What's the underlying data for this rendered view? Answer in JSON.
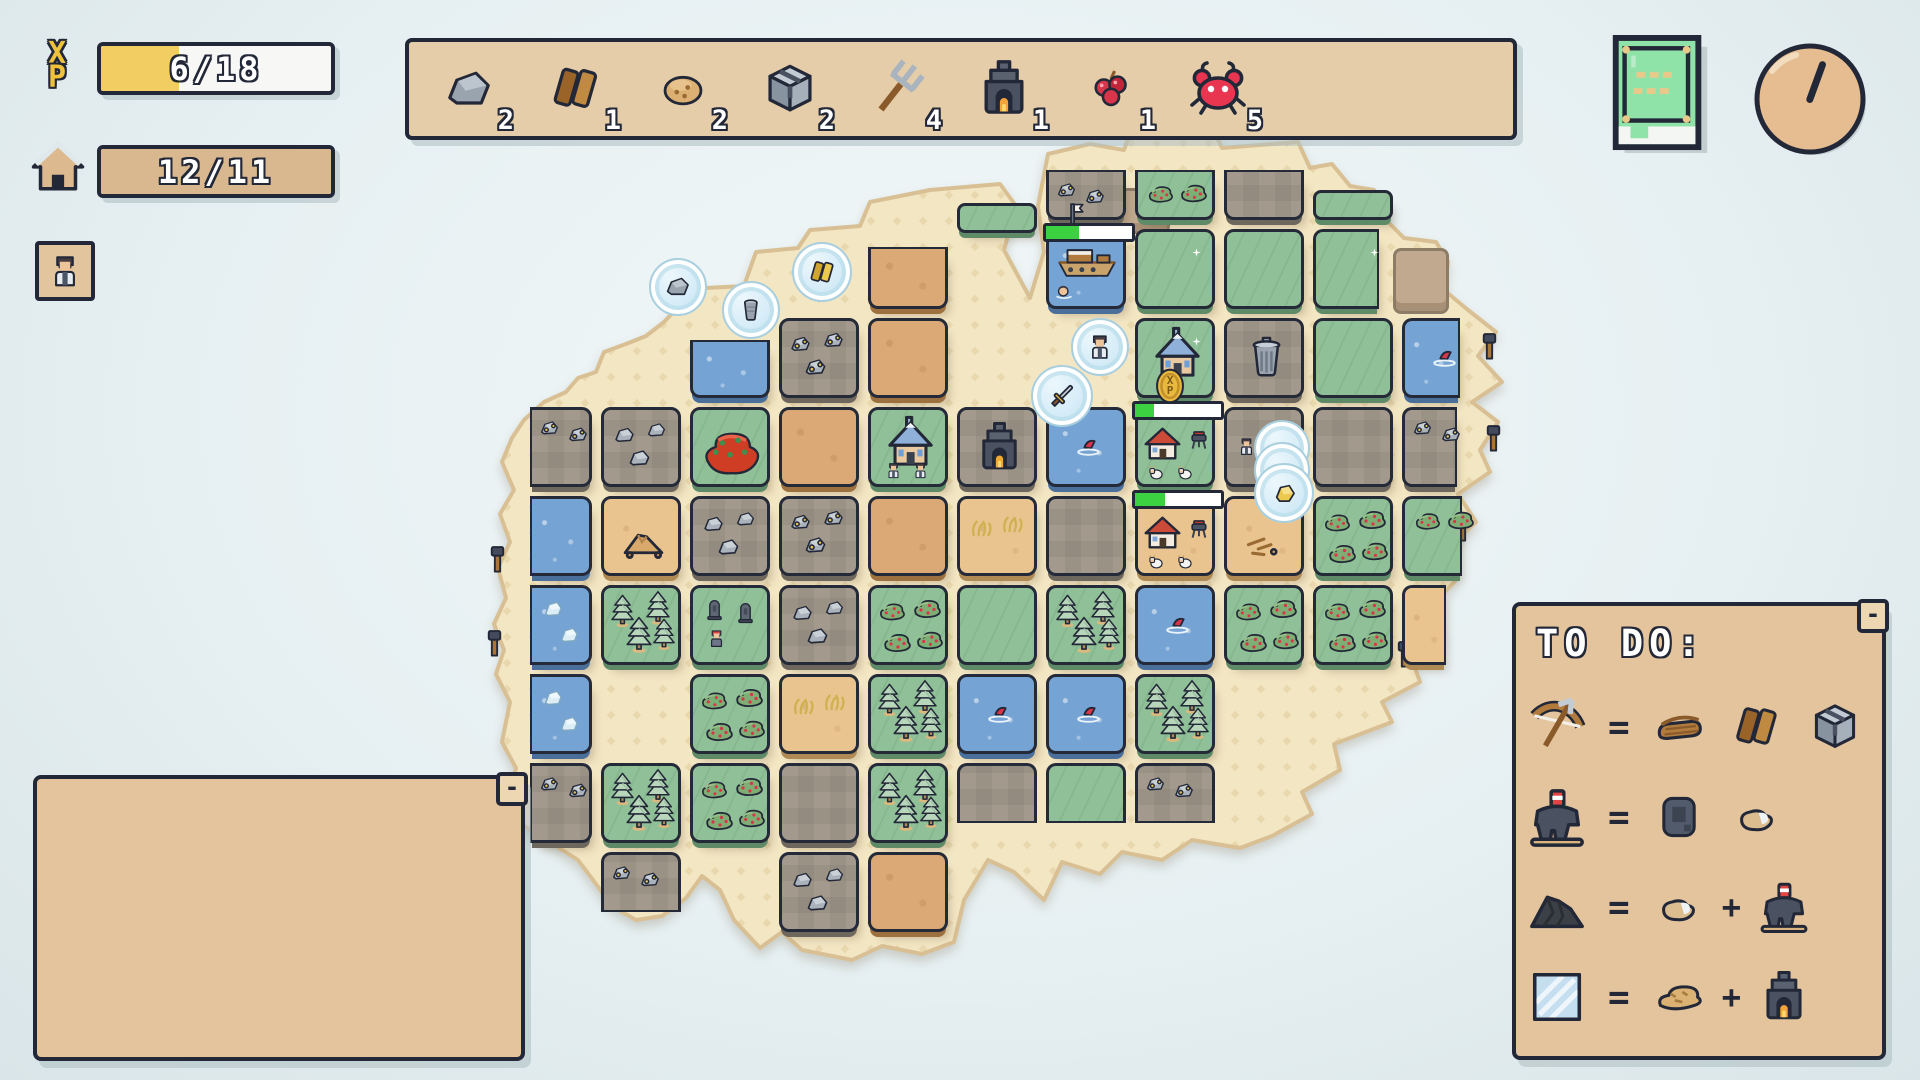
{
  "hud": {
    "xp": {
      "label_x": "X",
      "label_p": "P",
      "value": "6/18",
      "fill": 0.34,
      "fill_color": "#f2cd62"
    },
    "housing": {
      "value": "12/11",
      "fill": 1,
      "fill_color": "#d9b88f"
    },
    "avatar_button": {
      "icon": "villager-avatar"
    }
  },
  "inventory": {
    "items": [
      {
        "icon": "stone",
        "count": "2",
        "s": 56
      },
      {
        "icon": "planks",
        "count": "1",
        "s": 58
      },
      {
        "icon": "cookie",
        "count": "2",
        "s": 50
      },
      {
        "icon": "iron-cube",
        "count": "2",
        "s": 58
      },
      {
        "icon": "pitchfork",
        "count": "4",
        "s": 64
      },
      {
        "icon": "furnace",
        "count": "1",
        "s": 60
      },
      {
        "icon": "berries",
        "count": "1",
        "s": 46
      },
      {
        "icon": "crab",
        "count": "5",
        "s": 64
      }
    ]
  },
  "top_right": {
    "book_button": {
      "icon": "recipe-book"
    },
    "clock": {
      "icon": "clock",
      "hand_angle_deg": 20
    }
  },
  "todo": {
    "title": "TO DO:",
    "minimize_label": "-",
    "equals": "=",
    "plus": "+",
    "recipes": [
      {
        "result": "bow",
        "parts": [
          "leather",
          "planks",
          "iron-cube"
        ],
        "plus": false
      },
      {
        "result": "drill",
        "parts": [
          "iron-slab",
          "pebble"
        ],
        "plus": false
      },
      {
        "result": "coal",
        "parts": [
          "pebble",
          "drill"
        ],
        "plus": true
      },
      {
        "result": "glass",
        "parts": [
          "sand-lump",
          "furnace"
        ],
        "plus": true
      }
    ]
  },
  "bottom_left_panel": {
    "minimize_label": "-"
  },
  "map": {
    "origin": {
      "x": 512,
      "y": 140
    },
    "pitch": 89,
    "tile": 80,
    "tiles": [
      {
        "c": 6,
        "r": 0,
        "t": "stone",
        "f": [
          "ore2"
        ],
        "cut": "top"
      },
      {
        "c": 7,
        "r": 0,
        "t": "grass",
        "f": [
          "bushes2"
        ],
        "cut": "top"
      },
      {
        "c": 8,
        "r": 0,
        "t": "stone",
        "f": [],
        "cut": "top"
      },
      {
        "c": 9,
        "r": 0,
        "t": "grass",
        "f": [],
        "cut": "ledge"
      },
      {
        "c": 5,
        "r": 0,
        "t": "grass",
        "f": [],
        "cut": "ledge",
        "dy": 13
      },
      {
        "c": 4,
        "r": 1,
        "t": "dirt",
        "f": [],
        "cut": "top",
        "ch": 62
      },
      {
        "c": 6,
        "r": 1,
        "t": "water",
        "f": [
          "ship",
          "flag"
        ],
        "bar": 0.38
      },
      {
        "c": 7,
        "r": 1,
        "t": "grass",
        "f": [
          "sparkle"
        ]
      },
      {
        "c": 8,
        "r": 1,
        "t": "grass",
        "f": []
      },
      {
        "c": 9,
        "r": 1,
        "t": "grass",
        "f": [
          "sparkle"
        ],
        "cut": "right",
        "cw": 66
      },
      {
        "c": 2,
        "r": 2,
        "t": "water",
        "f": [],
        "cut": "top",
        "ch": 58
      },
      {
        "c": 3,
        "r": 2,
        "t": "stone",
        "f": [
          "ore"
        ]
      },
      {
        "c": 4,
        "r": 2,
        "t": "dirt",
        "f": []
      },
      {
        "c": 7,
        "r": 2,
        "t": "grass",
        "f": [
          "church",
          "sparkle"
        ]
      },
      {
        "c": 8,
        "r": 2,
        "t": "stone",
        "f": [
          "trashcan"
        ]
      },
      {
        "c": 9,
        "r": 2,
        "t": "grass",
        "f": []
      },
      {
        "c": 10,
        "r": 2,
        "t": "water",
        "f": [
          "fish"
        ],
        "cut": "right",
        "cw": 58
      },
      {
        "c": 0,
        "r": 3,
        "t": "stone",
        "f": [
          "ore2"
        ],
        "cut": "left"
      },
      {
        "c": 1,
        "r": 3,
        "t": "stone",
        "f": [
          "rocks"
        ]
      },
      {
        "c": 2,
        "r": 3,
        "t": "grass",
        "f": [
          "red-bush"
        ]
      },
      {
        "c": 3,
        "r": 3,
        "t": "dirt",
        "f": []
      },
      {
        "c": 4,
        "r": 3,
        "t": "grass",
        "f": [
          "church",
          "villagers"
        ]
      },
      {
        "c": 5,
        "r": 3,
        "t": "stone",
        "f": [
          "furnace"
        ]
      },
      {
        "c": 6,
        "r": 3,
        "t": "water",
        "f": [
          "fish"
        ]
      },
      {
        "c": 7,
        "r": 3,
        "t": "grass",
        "f": [
          "homestead",
          "goats"
        ],
        "bar": 0.22
      },
      {
        "c": 8,
        "r": 3,
        "t": "stone",
        "f": [
          "villager"
        ]
      },
      {
        "c": 9,
        "r": 3,
        "t": "stone",
        "f": []
      },
      {
        "c": 10,
        "r": 3,
        "t": "stone",
        "f": [
          "ore2"
        ],
        "cut": "right",
        "cw": 55
      },
      {
        "c": 0,
        "r": 4,
        "t": "water",
        "f": [],
        "cut": "left"
      },
      {
        "c": 1,
        "r": 4,
        "t": "sand",
        "f": [
          "sand-pile"
        ]
      },
      {
        "c": 2,
        "r": 4,
        "t": "stone",
        "f": [
          "rocks"
        ]
      },
      {
        "c": 3,
        "r": 4,
        "t": "stone",
        "f": [
          "ore"
        ]
      },
      {
        "c": 4,
        "r": 4,
        "t": "dirt",
        "f": []
      },
      {
        "c": 5,
        "r": 4,
        "t": "sand",
        "f": [
          "dry-grass"
        ]
      },
      {
        "c": 6,
        "r": 4,
        "t": "stone",
        "f": []
      },
      {
        "c": 7,
        "r": 4,
        "t": "sand",
        "f": [
          "homestead",
          "goats"
        ],
        "bar": 0.35
      },
      {
        "c": 8,
        "r": 4,
        "t": "sand",
        "f": [
          "sticks"
        ]
      },
      {
        "c": 9,
        "r": 4,
        "t": "grass",
        "f": [
          "bushes"
        ]
      },
      {
        "c": 10,
        "r": 4,
        "t": "grass",
        "f": [
          "bushes2"
        ],
        "cut": "right",
        "cw": 60
      },
      {
        "c": 0,
        "r": 5,
        "t": "water",
        "f": [
          "ice2"
        ],
        "cut": "left"
      },
      {
        "c": 1,
        "r": 5,
        "t": "grass",
        "f": [
          "pines"
        ]
      },
      {
        "c": 2,
        "r": 5,
        "t": "grass",
        "f": [
          "graves",
          "villager-red"
        ]
      },
      {
        "c": 3,
        "r": 5,
        "t": "stone",
        "f": [
          "rocks"
        ]
      },
      {
        "c": 4,
        "r": 5,
        "t": "grass",
        "f": [
          "bushes"
        ]
      },
      {
        "c": 5,
        "r": 5,
        "t": "grass",
        "f": []
      },
      {
        "c": 6,
        "r": 5,
        "t": "grass",
        "f": [
          "pines"
        ]
      },
      {
        "c": 7,
        "r": 5,
        "t": "water",
        "f": [
          "fish"
        ]
      },
      {
        "c": 8,
        "r": 5,
        "t": "grass",
        "f": [
          "bushes"
        ]
      },
      {
        "c": 9,
        "r": 5,
        "t": "grass",
        "f": [
          "bushes"
        ]
      },
      {
        "c": 10,
        "r": 5,
        "t": "sand",
        "f": [],
        "cut": "right",
        "cw": 44
      },
      {
        "c": 0,
        "r": 6,
        "t": "water",
        "f": [
          "ice2"
        ],
        "cut": "left"
      },
      {
        "c": 2,
        "r": 6,
        "t": "grass",
        "f": [
          "bushes"
        ]
      },
      {
        "c": 3,
        "r": 6,
        "t": "sand",
        "f": [
          "dry-grass"
        ]
      },
      {
        "c": 4,
        "r": 6,
        "t": "grass",
        "f": [
          "pines"
        ]
      },
      {
        "c": 5,
        "r": 6,
        "t": "water",
        "f": [
          "fish"
        ]
      },
      {
        "c": 6,
        "r": 6,
        "t": "water",
        "f": [
          "fish"
        ]
      },
      {
        "c": 7,
        "r": 6,
        "t": "grass",
        "f": [
          "pines"
        ]
      },
      {
        "c": 0,
        "r": 7,
        "t": "stone",
        "f": [
          "ore2"
        ],
        "cut": "left"
      },
      {
        "c": 1,
        "r": 7,
        "t": "grass",
        "f": [
          "pines"
        ]
      },
      {
        "c": 2,
        "r": 7,
        "t": "grass",
        "f": [
          "bushes"
        ]
      },
      {
        "c": 3,
        "r": 7,
        "t": "stone",
        "f": []
      },
      {
        "c": 4,
        "r": 7,
        "t": "grass",
        "f": [
          "pines"
        ]
      },
      {
        "c": 5,
        "r": 7,
        "t": "stone",
        "f": [],
        "cut": "bottom"
      },
      {
        "c": 6,
        "r": 7,
        "t": "grass",
        "f": [],
        "cut": "bottom"
      },
      {
        "c": 7,
        "r": 7,
        "t": "stone",
        "f": [
          "ore2"
        ],
        "cut": "bottom"
      },
      {
        "c": 1,
        "r": 8,
        "t": "stone",
        "f": [
          "ore2"
        ],
        "cut": "bottom"
      },
      {
        "c": 3,
        "r": 8,
        "t": "stone",
        "f": [
          "rocks"
        ]
      },
      {
        "c": 4,
        "r": 8,
        "t": "dirt",
        "f": []
      }
    ],
    "bubbles": [
      {
        "x": 676,
        "y": 285,
        "r": 27,
        "item": "stone"
      },
      {
        "x": 749,
        "y": 308,
        "r": 27,
        "item": "bucket"
      },
      {
        "x": 820,
        "y": 270,
        "r": 28,
        "item": "gold-planks"
      },
      {
        "x": 1098,
        "y": 345,
        "r": 27,
        "item": "villager-avatar"
      },
      {
        "x": 1060,
        "y": 394,
        "r": 29,
        "item": "sword"
      },
      {
        "x": 1280,
        "y": 446,
        "r": 26,
        "item": null
      },
      {
        "x": 1280,
        "y": 468,
        "r": 26,
        "item": null
      },
      {
        "x": 1282,
        "y": 491,
        "r": 28,
        "item": "nugget"
      }
    ],
    "coin_badge": {
      "x": 1170,
      "y": 386,
      "label": "X\nP"
    },
    "edge_posts": [
      {
        "x": 1489,
        "y": 336
      },
      {
        "x": 1493,
        "y": 428
      },
      {
        "x": 1462,
        "y": 518
      },
      {
        "x": 1404,
        "y": 644
      },
      {
        "x": 497,
        "y": 549
      },
      {
        "x": 494,
        "y": 633
      }
    ],
    "decor_patches": [
      {
        "x": 1114,
        "y": 188,
        "w": 50,
        "h": 40
      },
      {
        "x": 1393,
        "y": 248,
        "w": 50,
        "h": 60
      }
    ]
  },
  "colors": {
    "accent_green": "#3bd141",
    "xp_yellow": "#f2cd62",
    "panel_tan": "#e3c49c",
    "outline": "#232838",
    "water": "#74a3d4",
    "grass": "#90c097"
  }
}
